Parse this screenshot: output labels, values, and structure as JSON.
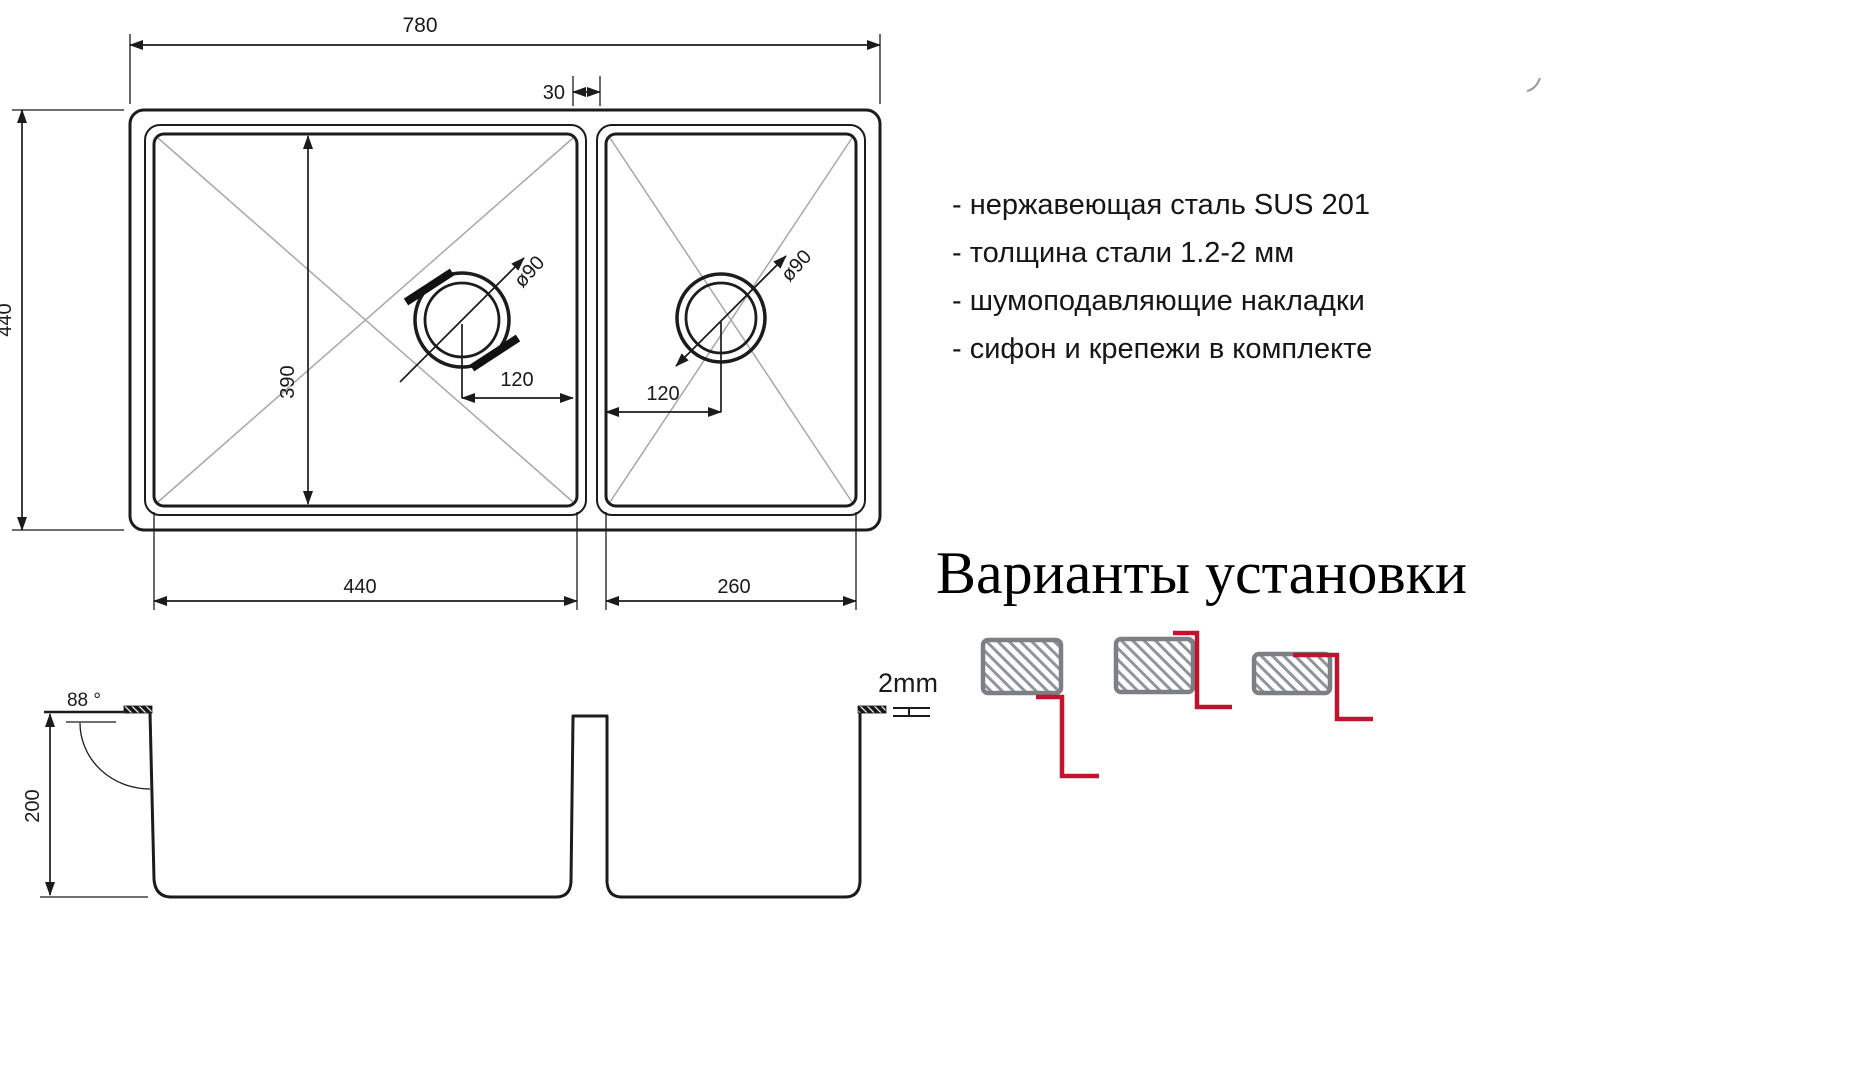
{
  "drawing": {
    "top_view": {
      "overall_width": "780",
      "divider_gap": "30",
      "overall_depth": "440",
      "bowl_depth": "390",
      "bowl1_width": "440",
      "bowl2_width": "260",
      "drain1_offset": "120",
      "drain2_offset": "120",
      "drain1_diameter": "ø90",
      "drain2_diameter": "ø90"
    },
    "side_view": {
      "height": "200",
      "wall_angle": "88 °",
      "sheet_thickness": "2mm"
    }
  },
  "specs": {
    "items": [
      "- нержавеющая сталь SUS 201",
      "- толщина стали 1.2-2 мм",
      "- шумоподавляющие накладки",
      "- сифон и крепежи в комплекте"
    ]
  },
  "installation": {
    "title": "Варианты установки",
    "options": [
      "undermount",
      "flush-mount",
      "top-mount"
    ]
  },
  "colors": {
    "accent_red": "#c0132f",
    "line": "#1b1b1b",
    "hatch_gray": "#8f959a",
    "diagonal_gray": "#a8a8a8"
  }
}
